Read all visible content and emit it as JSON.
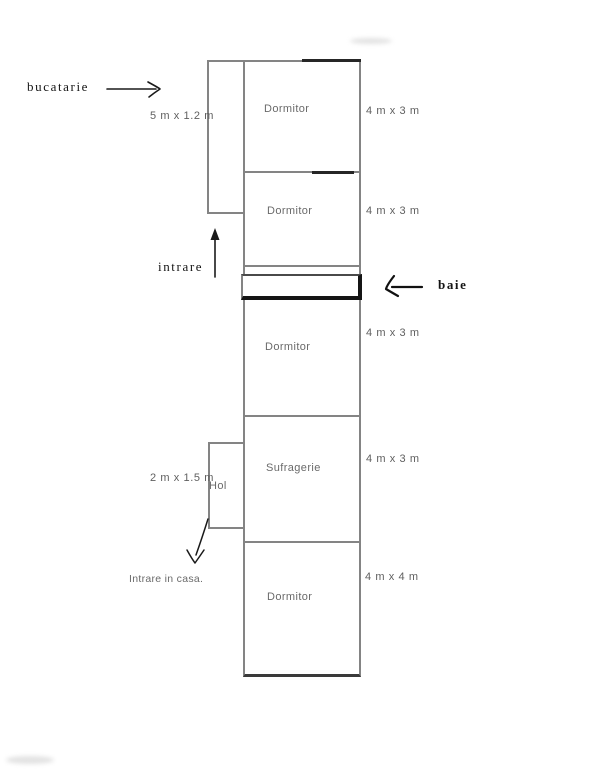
{
  "rooms": [
    {
      "name": "Dormitor",
      "size": "4 m x 3 m"
    },
    {
      "name": "Dormitor",
      "size": "4 m x 3 m"
    },
    {
      "name": "Dormitor",
      "size": "4 m x 3 m"
    },
    {
      "name": "Sufragerie",
      "size": "4 m x 3 m"
    },
    {
      "name": "Dormitor",
      "size": "4 m x 4 m"
    }
  ],
  "side_rooms": {
    "hol_label": "Hol",
    "hol_size": "2 m x 1.5 m",
    "kitchen_size": "5 m x 1.2 m"
  },
  "annotations": {
    "kitchen": "bucatarie",
    "entrance": "intrare",
    "bathroom": "baie",
    "house_entrance": "Intrare in casa."
  },
  "colors": {
    "wall": "#848484",
    "wall_dark": "#262626",
    "baie_border": "#151515",
    "room_label": "#6a6a6a",
    "dim_label": "#5f5f5f",
    "annotation": "#141414",
    "background": "#ffffff"
  }
}
